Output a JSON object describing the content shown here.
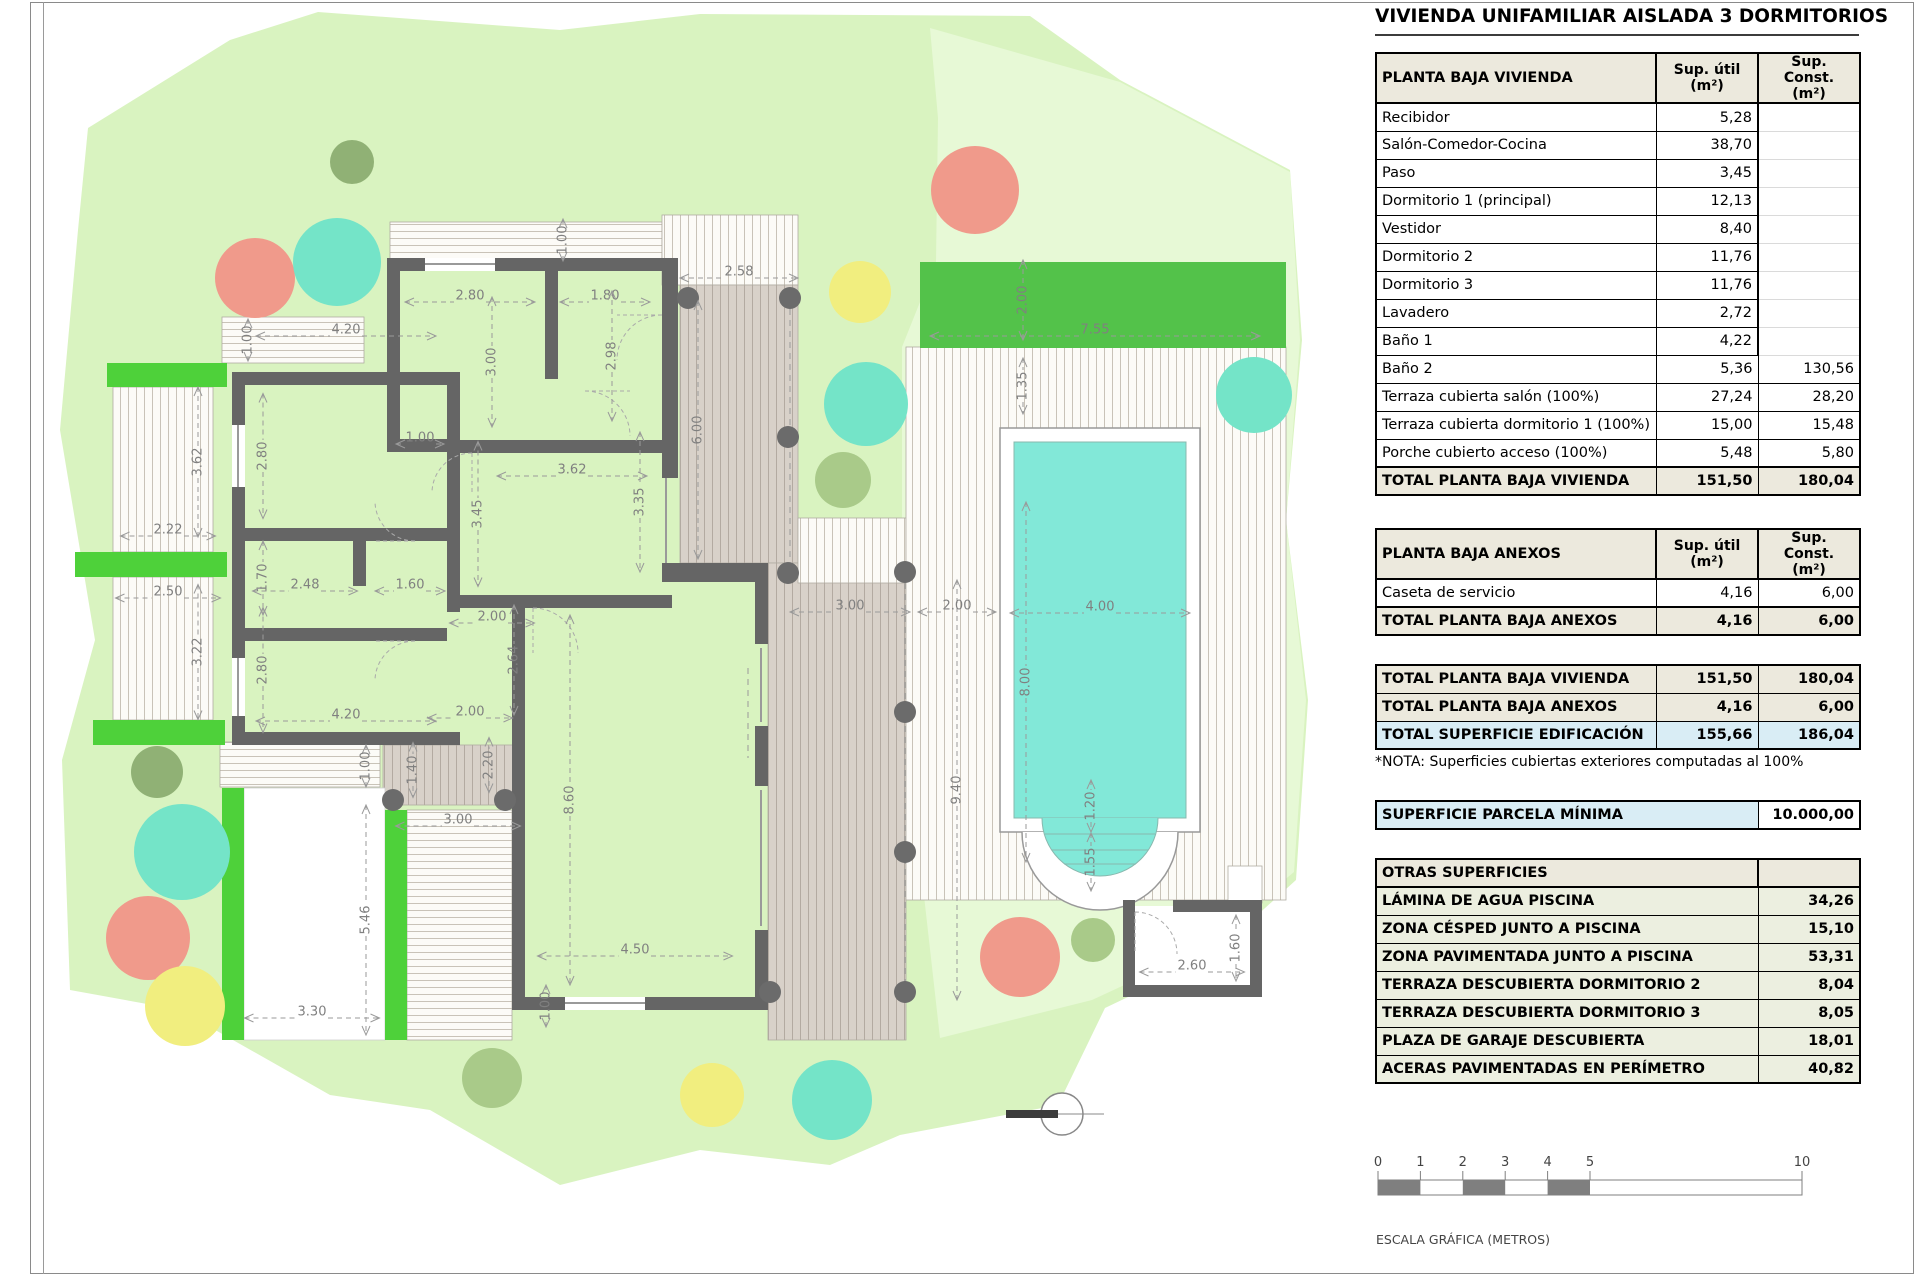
{
  "title": "VIVIENDA UNIFAMILIAR AISLADA 3 DORMITORIOS",
  "tables": {
    "planta_baja": {
      "header": {
        "label": "PLANTA BAJA VIVIENDA",
        "util": "Sup. útil\n(m²)",
        "const": "Sup. Const.\n(m²)"
      },
      "rows": [
        {
          "label": "Recibidor",
          "util": "5,28",
          "const": ""
        },
        {
          "label": "Salón-Comedor-Cocina",
          "util": "38,70",
          "const": ""
        },
        {
          "label": "Paso",
          "util": "3,45",
          "const": ""
        },
        {
          "label": "Dormitorio 1 (principal)",
          "util": "12,13",
          "const": ""
        },
        {
          "label": "Vestidor",
          "util": "8,40",
          "const": ""
        },
        {
          "label": "Dormitorio 2",
          "util": "11,76",
          "const": ""
        },
        {
          "label": "Dormitorio 3",
          "util": "11,76",
          "const": ""
        },
        {
          "label": "Lavadero",
          "util": "2,72",
          "const": ""
        },
        {
          "label": "Baño 1",
          "util": "4,22",
          "const": ""
        },
        {
          "label": "Baño 2",
          "util": "5,36",
          "const": "130,56"
        },
        {
          "label": "Terraza cubierta salón (100%)",
          "util": "27,24",
          "const": "28,20"
        },
        {
          "label": "Terraza cubierta dormitorio 1 (100%)",
          "util": "15,00",
          "const": "15,48"
        },
        {
          "label": "Porche cubierto acceso (100%)",
          "util": "5,48",
          "const": "5,80"
        }
      ],
      "total": {
        "label": "TOTAL PLANTA BAJA VIVIENDA",
        "util": "151,50",
        "const": "180,04"
      }
    },
    "anexos": {
      "header": {
        "label": "PLANTA BAJA ANEXOS",
        "util": "Sup. útil\n(m²)",
        "const": "Sup. Const.\n(m²)"
      },
      "rows": [
        {
          "label": "Caseta de servicio",
          "util": "4,16",
          "const": "6,00"
        }
      ],
      "total": {
        "label": "TOTAL PLANTA BAJA ANEXOS",
        "util": "4,16",
        "const": "6,00"
      }
    },
    "totales": {
      "rows": [
        {
          "label": "TOTAL PLANTA BAJA VIVIENDA",
          "util": "151,50",
          "const": "180,04"
        },
        {
          "label": "TOTAL PLANTA BAJA ANEXOS",
          "util": "4,16",
          "const": "6,00"
        },
        {
          "label": "TOTAL SUPERFICIE EDIFICACIÓN",
          "util": "155,66",
          "const": "186,04"
        }
      ]
    },
    "nota": "*NOTA: Superficies cubiertas exteriores computadas al 100%",
    "parcela": {
      "label": "SUPERFICIE PARCELA MÍNIMA",
      "value": "10.000,00"
    },
    "otras": {
      "header": "OTRAS SUPERFICIES",
      "rows": [
        {
          "label": "LÁMINA DE AGUA PISCINA",
          "value": "34,26"
        },
        {
          "label": "ZONA CÉSPED JUNTO A PISCINA",
          "value": "15,10"
        },
        {
          "label": "ZONA PAVIMENTADA JUNTO A PISCINA",
          "value": "53,31"
        },
        {
          "label": "TERRAZA DESCUBIERTA DORMITORIO 2",
          "value": "8,04"
        },
        {
          "label": "TERRAZA DESCUBIERTA DORMITORIO 3",
          "value": "8,05"
        },
        {
          "label": "PLAZA DE GARAJE DESCUBIERTA",
          "value": "18,01"
        },
        {
          "label": "ACERAS PAVIMENTADAS EN PERÍMETRO",
          "value": "40,82"
        }
      ]
    }
  },
  "scalebar": {
    "ticks": [
      {
        "t": "0",
        "m": 0
      },
      {
        "t": "1",
        "m": 1
      },
      {
        "t": "2",
        "m": 2
      },
      {
        "t": "3",
        "m": 3
      },
      {
        "t": "4",
        "m": 4
      },
      {
        "t": "5",
        "m": 5
      },
      {
        "t": "10",
        "m": 10
      }
    ],
    "label": "ESCALA GRÁFICA (METROS)"
  },
  "colors": {
    "wall": "#656565",
    "lawn": "#d9f3c0",
    "lawn_light": "#e7f9d6",
    "hedge": "#4ed13a",
    "hedge_pool": "#53c24a",
    "water": "#82e8d8",
    "salmon": "#f09a8b",
    "turquoise": "#74e4c8",
    "yellow": "#f1ee7f",
    "olive": "#a9ca89",
    "dark_olive": "#90b175",
    "header_bg": "#ece9dd",
    "highlight": "#d9edf5",
    "otras_bg": "#ecefe0",
    "scale_gray": "#7f7f7f"
  },
  "plan": {
    "dim_labels": [
      {
        "t": "1.00",
        "x": 563,
        "y": 240,
        "v": 1,
        "l": 42
      },
      {
        "t": "2.58",
        "x": 739,
        "y": 272,
        "v": 0,
        "l": 118
      },
      {
        "t": "2.80",
        "x": 470,
        "y": 296,
        "v": 0,
        "l": 130
      },
      {
        "t": "1.80",
        "x": 605,
        "y": 296,
        "v": 0,
        "l": 90
      },
      {
        "t": "3.00",
        "x": 492,
        "y": 362,
        "v": 1,
        "l": 130
      },
      {
        "t": "2.98",
        "x": 612,
        "y": 356,
        "v": 1,
        "l": 130
      },
      {
        "t": "6.00",
        "x": 698,
        "y": 430,
        "v": 1,
        "l": 258
      },
      {
        "t": "1.00",
        "x": 248,
        "y": 340,
        "v": 1,
        "l": 42
      },
      {
        "t": "4.20",
        "x": 346,
        "y": 330,
        "v": 0,
        "l": 180
      },
      {
        "t": "2.80",
        "x": 263,
        "y": 456,
        "v": 1,
        "l": 125
      },
      {
        "t": "3.62",
        "x": 198,
        "y": 462,
        "v": 1,
        "l": 150
      },
      {
        "t": "2.22",
        "x": 168,
        "y": 530,
        "v": 0,
        "l": 95
      },
      {
        "t": "1.00",
        "x": 420,
        "y": 438,
        "v": 0,
        "l": 48
      },
      {
        "t": "3.62",
        "x": 572,
        "y": 470,
        "v": 0,
        "l": 150
      },
      {
        "t": "3.45",
        "x": 478,
        "y": 514,
        "v": 1,
        "l": 145
      },
      {
        "t": "3.35",
        "x": 640,
        "y": 502,
        "v": 1,
        "l": 140
      },
      {
        "t": "1.70",
        "x": 263,
        "y": 578,
        "v": 1,
        "l": 74
      },
      {
        "t": "2.48",
        "x": 305,
        "y": 585,
        "v": 0,
        "l": 105
      },
      {
        "t": "1.60",
        "x": 410,
        "y": 585,
        "v": 0,
        "l": 70
      },
      {
        "t": "2.50",
        "x": 168,
        "y": 592,
        "v": 0,
        "l": 105
      },
      {
        "t": "3.22",
        "x": 198,
        "y": 652,
        "v": 1,
        "l": 135
      },
      {
        "t": "2.80",
        "x": 263,
        "y": 670,
        "v": 1,
        "l": 125
      },
      {
        "t": "4.20",
        "x": 346,
        "y": 715,
        "v": 0,
        "l": 180
      },
      {
        "t": "2.00",
        "x": 492,
        "y": 617,
        "v": 0,
        "l": 85
      },
      {
        "t": "2.64",
        "x": 514,
        "y": 660,
        "v": 1,
        "l": 110
      },
      {
        "t": "2.00",
        "x": 470,
        "y": 712,
        "v": 0,
        "l": 85
      },
      {
        "t": "1.40",
        "x": 413,
        "y": 770,
        "v": 1,
        "l": 55
      },
      {
        "t": "2.20",
        "x": 489,
        "y": 765,
        "v": 1,
        "l": 55
      },
      {
        "t": "1.00",
        "x": 366,
        "y": 766,
        "v": 1,
        "l": 42
      },
      {
        "t": "3.00",
        "x": 458,
        "y": 820,
        "v": 0,
        "l": 125
      },
      {
        "t": "8.60",
        "x": 570,
        "y": 800,
        "v": 1,
        "l": 370
      },
      {
        "t": "5.46",
        "x": 366,
        "y": 920,
        "v": 1,
        "l": 230
      },
      {
        "t": "3.30",
        "x": 312,
        "y": 1012,
        "v": 0,
        "l": 135
      },
      {
        "t": "4.50",
        "x": 635,
        "y": 950,
        "v": 0,
        "l": 195
      },
      {
        "t": "1.00",
        "x": 546,
        "y": 1006,
        "v": 1,
        "l": 42
      },
      {
        "t": "3.00",
        "x": 850,
        "y": 606,
        "v": 0,
        "l": 120
      },
      {
        "t": "9.40",
        "x": 957,
        "y": 790,
        "v": 1,
        "l": 420
      },
      {
        "t": "2.00",
        "x": 957,
        "y": 606,
        "v": 0,
        "l": 78
      },
      {
        "t": "2.00",
        "x": 1023,
        "y": 300,
        "v": 1,
        "l": 80
      },
      {
        "t": "7.55",
        "x": 1095,
        "y": 330,
        "v": 0,
        "l": 330
      },
      {
        "t": "1.35",
        "x": 1023,
        "y": 386,
        "v": 1,
        "l": 56
      },
      {
        "t": "4.00",
        "x": 1100,
        "y": 607,
        "v": 0,
        "l": 180
      },
      {
        "t": "8.00",
        "x": 1026,
        "y": 682,
        "v": 1,
        "l": 360
      },
      {
        "t": "1.20",
        "x": 1091,
        "y": 806,
        "v": 1,
        "l": 52
      },
      {
        "t": "1.55",
        "x": 1091,
        "y": 862,
        "v": 1,
        "l": 58
      },
      {
        "t": "2.60",
        "x": 1192,
        "y": 966,
        "v": 0,
        "l": 105
      },
      {
        "t": "1.60",
        "x": 1236,
        "y": 948,
        "v": 1,
        "l": 66
      }
    ],
    "trees": [
      {
        "x": 255,
        "y": 278,
        "r": 40,
        "c": "salmon"
      },
      {
        "x": 337,
        "y": 262,
        "r": 44,
        "c": "turquoise"
      },
      {
        "x": 352,
        "y": 162,
        "r": 22,
        "c": "dark_olive"
      },
      {
        "x": 975,
        "y": 190,
        "r": 44,
        "c": "salmon"
      },
      {
        "x": 860,
        "y": 292,
        "r": 31,
        "c": "yellow"
      },
      {
        "x": 866,
        "y": 404,
        "r": 42,
        "c": "turquoise"
      },
      {
        "x": 843,
        "y": 480,
        "r": 28,
        "c": "olive"
      },
      {
        "x": 1254,
        "y": 395,
        "r": 38,
        "c": "turquoise"
      },
      {
        "x": 157,
        "y": 772,
        "r": 26,
        "c": "dark_olive"
      },
      {
        "x": 182,
        "y": 852,
        "r": 48,
        "c": "turquoise"
      },
      {
        "x": 148,
        "y": 938,
        "r": 42,
        "c": "salmon"
      },
      {
        "x": 185,
        "y": 1006,
        "r": 40,
        "c": "yellow"
      },
      {
        "x": 492,
        "y": 1078,
        "r": 30,
        "c": "olive"
      },
      {
        "x": 712,
        "y": 1095,
        "r": 32,
        "c": "yellow"
      },
      {
        "x": 832,
        "y": 1100,
        "r": 40,
        "c": "turquoise"
      },
      {
        "x": 1020,
        "y": 957,
        "r": 40,
        "c": "salmon"
      },
      {
        "x": 1093,
        "y": 940,
        "r": 22,
        "c": "olive"
      }
    ],
    "columns": [
      [
        688,
        298
      ],
      [
        790,
        298
      ],
      [
        788,
        437
      ],
      [
        788,
        573
      ],
      [
        905,
        572
      ],
      [
        905,
        712
      ],
      [
        905,
        852
      ],
      [
        905,
        992
      ],
      [
        770,
        992
      ],
      [
        393,
        800
      ],
      [
        505,
        800
      ]
    ]
  }
}
